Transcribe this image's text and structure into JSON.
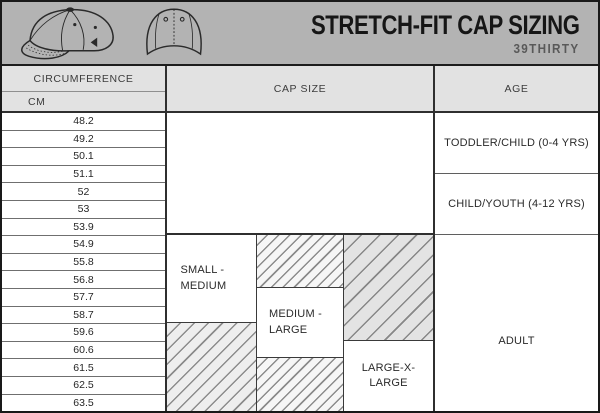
{
  "header": {
    "title": "STRETCH-FIT CAP SIZING",
    "subtitle": "39THIRTY"
  },
  "labels": {
    "circumference": "CIRCUMFERENCE",
    "cm": "CM",
    "cap_size": "CAP SIZE",
    "age": "AGE"
  },
  "icons": {
    "cap_side": "cap-side-view",
    "cap_front": "cap-front-view"
  },
  "colors": {
    "banner_bg": "#b3b3b3",
    "table_header_bg": "#e2e2e2",
    "strong_grid": "#2f2f2f",
    "thin_grid": "#6f6f6f",
    "hatch_line": "#8c8c8c",
    "hatch_sparse_bg": "#e3e3e3",
    "text_dark": "#262626",
    "subtitle_gray": "#595959"
  },
  "chart_data": {
    "type": "table",
    "title": "STRETCH-FIT CAP SIZING",
    "subtitle": "39THIRTY",
    "unit": "CM",
    "circumference_cm": [
      48.2,
      49.2,
      50.1,
      51.1,
      52,
      53,
      53.9,
      54.9,
      55.8,
      56.8,
      57.7,
      58.7,
      59.6,
      60.6,
      61.5,
      62.5,
      63.5
    ],
    "cap_size_ranges": [
      {
        "label": "SMALL - MEDIUM",
        "min_cm": 54.9,
        "max_cm": 58.7,
        "hatched_extension_max_cm": 63.5
      },
      {
        "label": "MEDIUM - LARGE",
        "min_cm": 57.7,
        "max_cm": 60.6,
        "hatched_extension_min_cm": 54.9,
        "hatched_extension_max_cm": 63.5
      },
      {
        "label": "LARGE-X-LARGE",
        "min_cm": 60.6,
        "max_cm": 63.5,
        "hatched_extension_min_cm": 54.9
      }
    ],
    "age_ranges": [
      {
        "label": "TODDLER/CHILD (0-4 YRS)",
        "min_cm": 48.2,
        "max_cm": 51.1
      },
      {
        "label": "CHILD/YOUTH (4-12 YRS)",
        "min_cm": 51.1,
        "max_cm": 53.9
      },
      {
        "label": "ADULT",
        "min_cm": 54.9,
        "max_cm": 63.5
      }
    ]
  }
}
